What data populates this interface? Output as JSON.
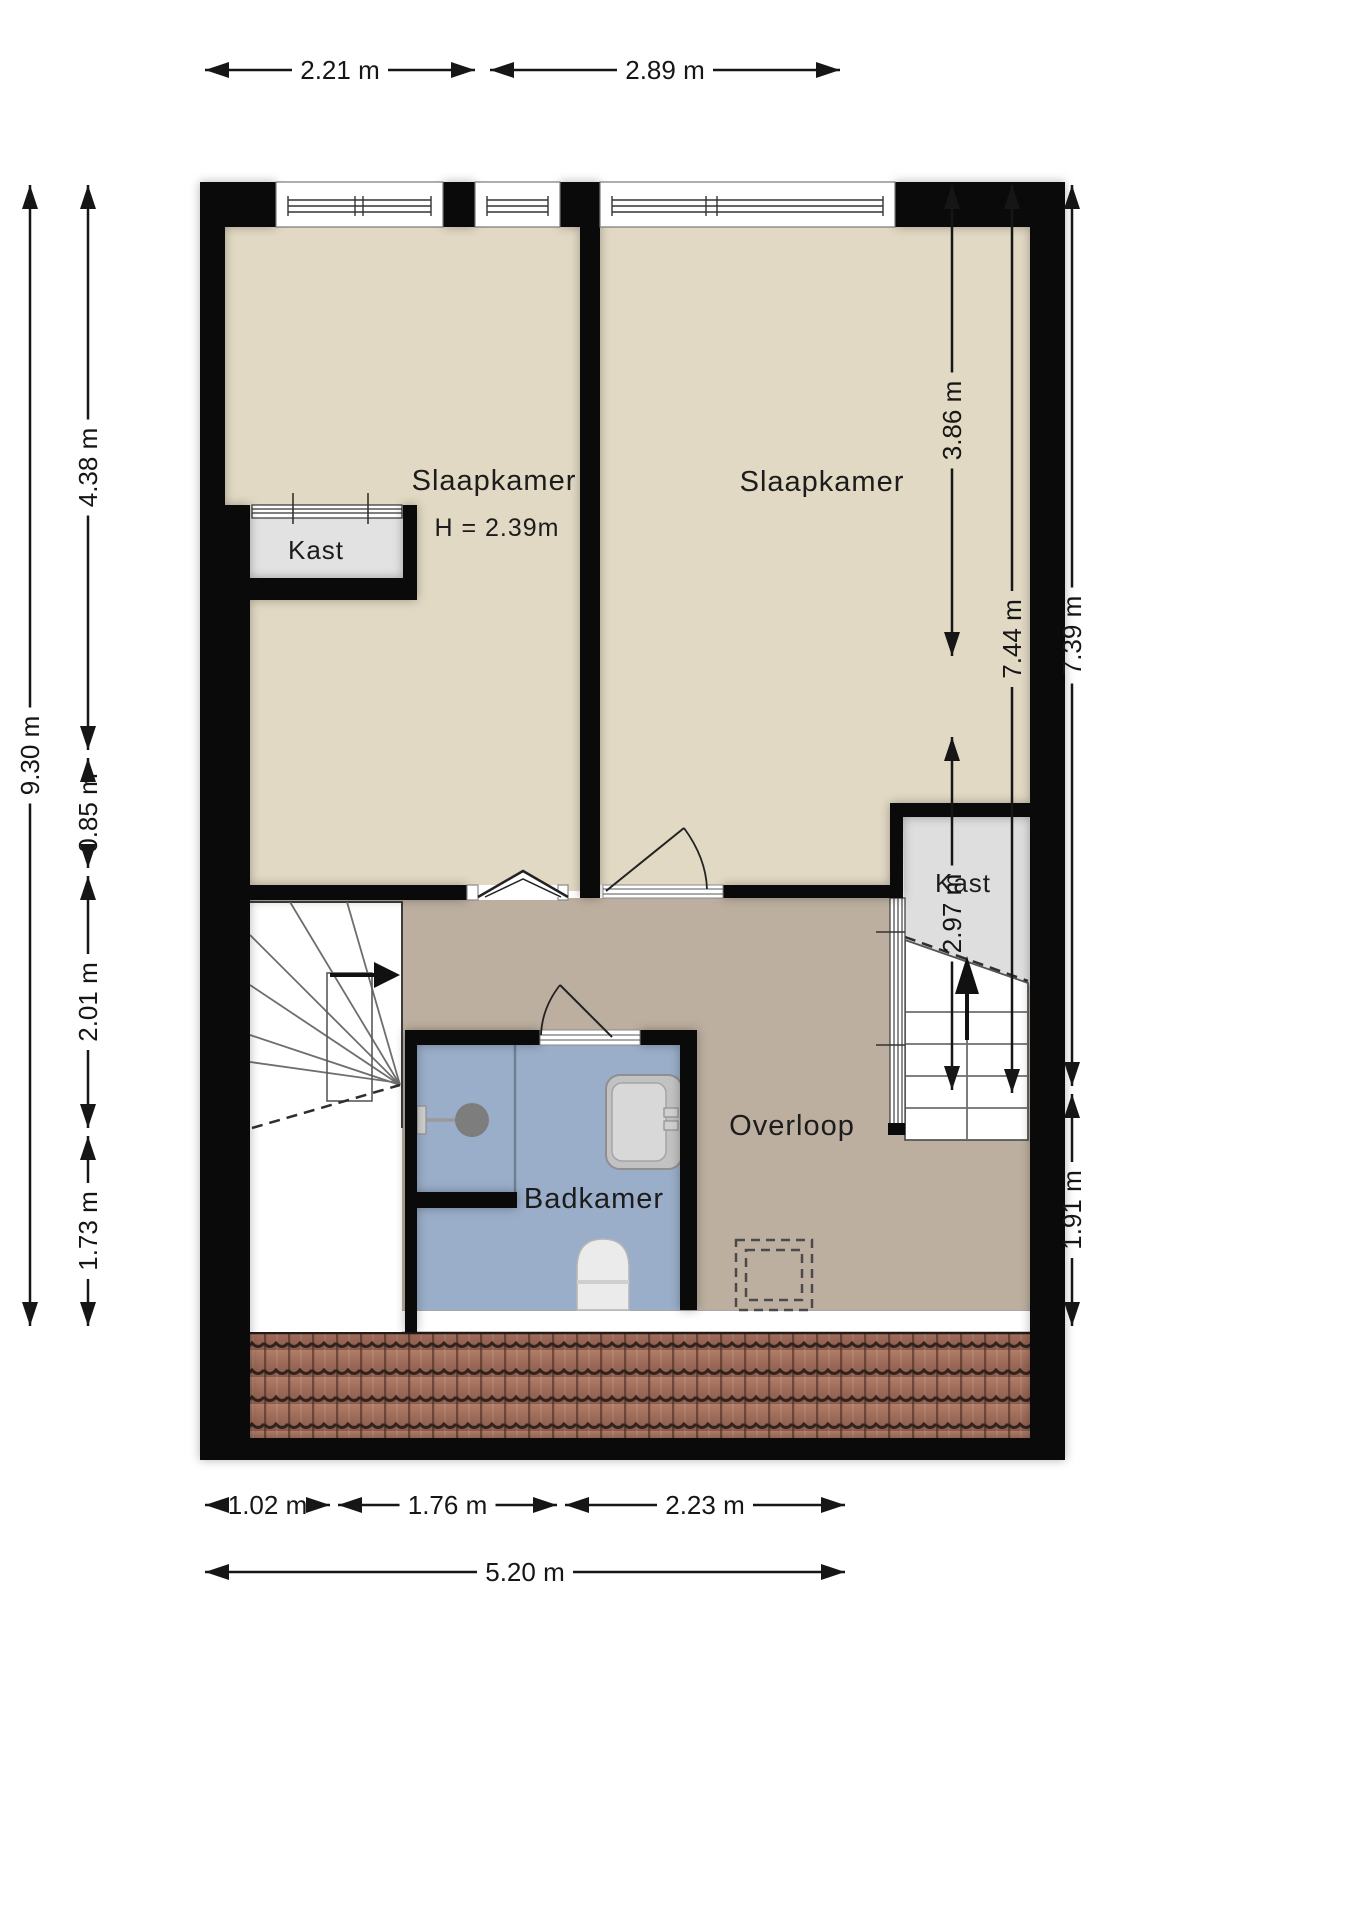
{
  "rooms": {
    "bedroom1": {
      "label": "Slaapkamer",
      "height_note": "H = 2.39m"
    },
    "bedroom2": {
      "label": "Slaapkamer"
    },
    "landing": {
      "label": "Overloop"
    },
    "bathroom": {
      "label": "Badkamer"
    },
    "closet_left": {
      "label": "Kast"
    },
    "closet_right": {
      "label": "Kast"
    }
  },
  "dimensions": {
    "top": [
      "2.21 m",
      "2.89 m"
    ],
    "left": [
      "9.30 m",
      "4.38 m",
      "0.85 m",
      "2.01 m",
      "1.73 m"
    ],
    "right": [
      "3.86 m",
      "7.44 m",
      "7.39 m",
      "2.97 m",
      "1.91 m"
    ],
    "bottom": [
      "1.02 m",
      "1.76 m",
      "2.23 m",
      "5.20 m"
    ]
  },
  "colors": {
    "wall": "#0a0a0a",
    "bedroom_floor": "#e1d9c3",
    "landing_floor": "#bcaf9f",
    "bathroom_floor": "#9aaec9",
    "closet_floor": "#e2e2e2",
    "roof_tiles": "#a06a57",
    "dimension_ink": "#161616"
  }
}
